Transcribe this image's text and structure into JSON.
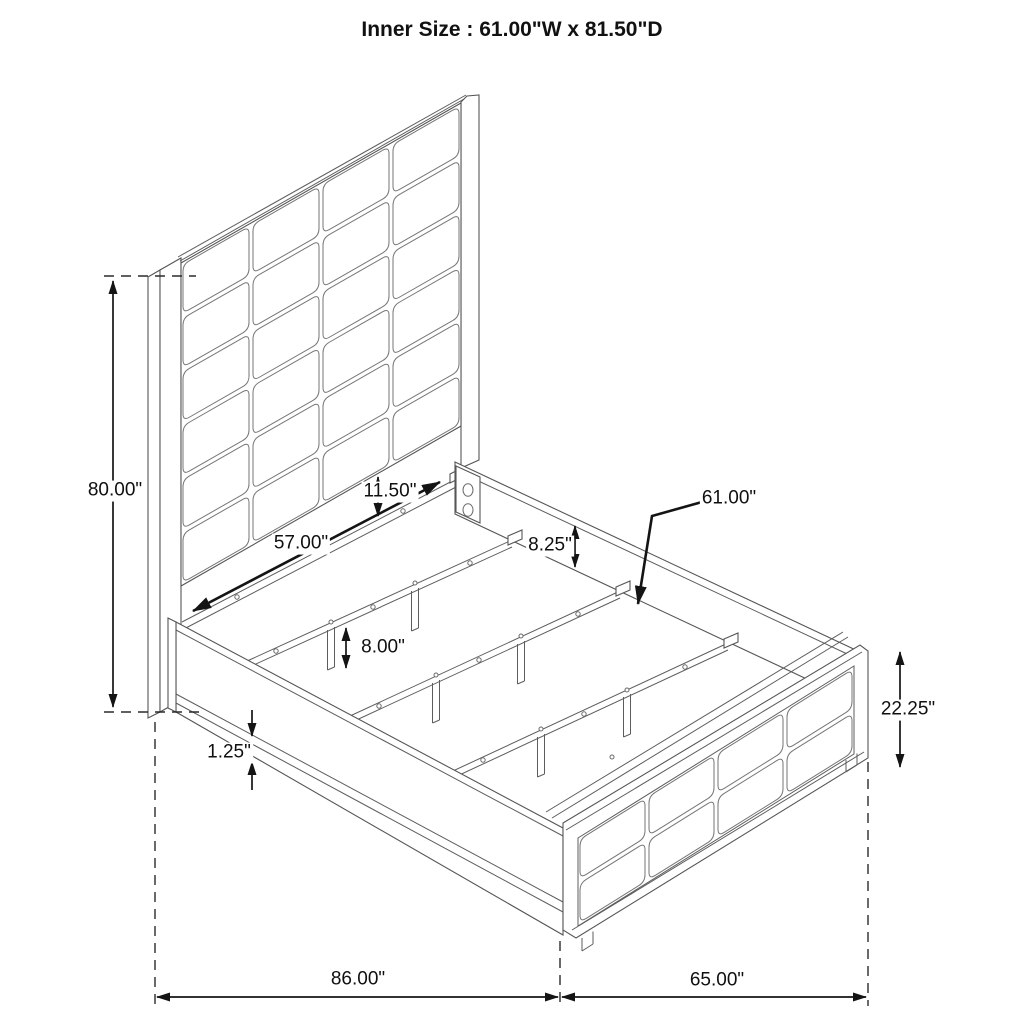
{
  "title": "Inner Size : 61.00\"W x 81.50\"D",
  "dimensions": {
    "headboard_height": "80.00\"",
    "headboard_panel_gap": "11.50\"",
    "inner_rail_width": "57.00\"",
    "rail_to_slat": "8.25\"",
    "slat_length": "61.00\"",
    "center_leg_height": "8.00\"",
    "rail_lip": "1.25\"",
    "footboard_height": "22.25\"",
    "overall_depth": "86.00\"",
    "overall_width": "65.00\""
  }
}
